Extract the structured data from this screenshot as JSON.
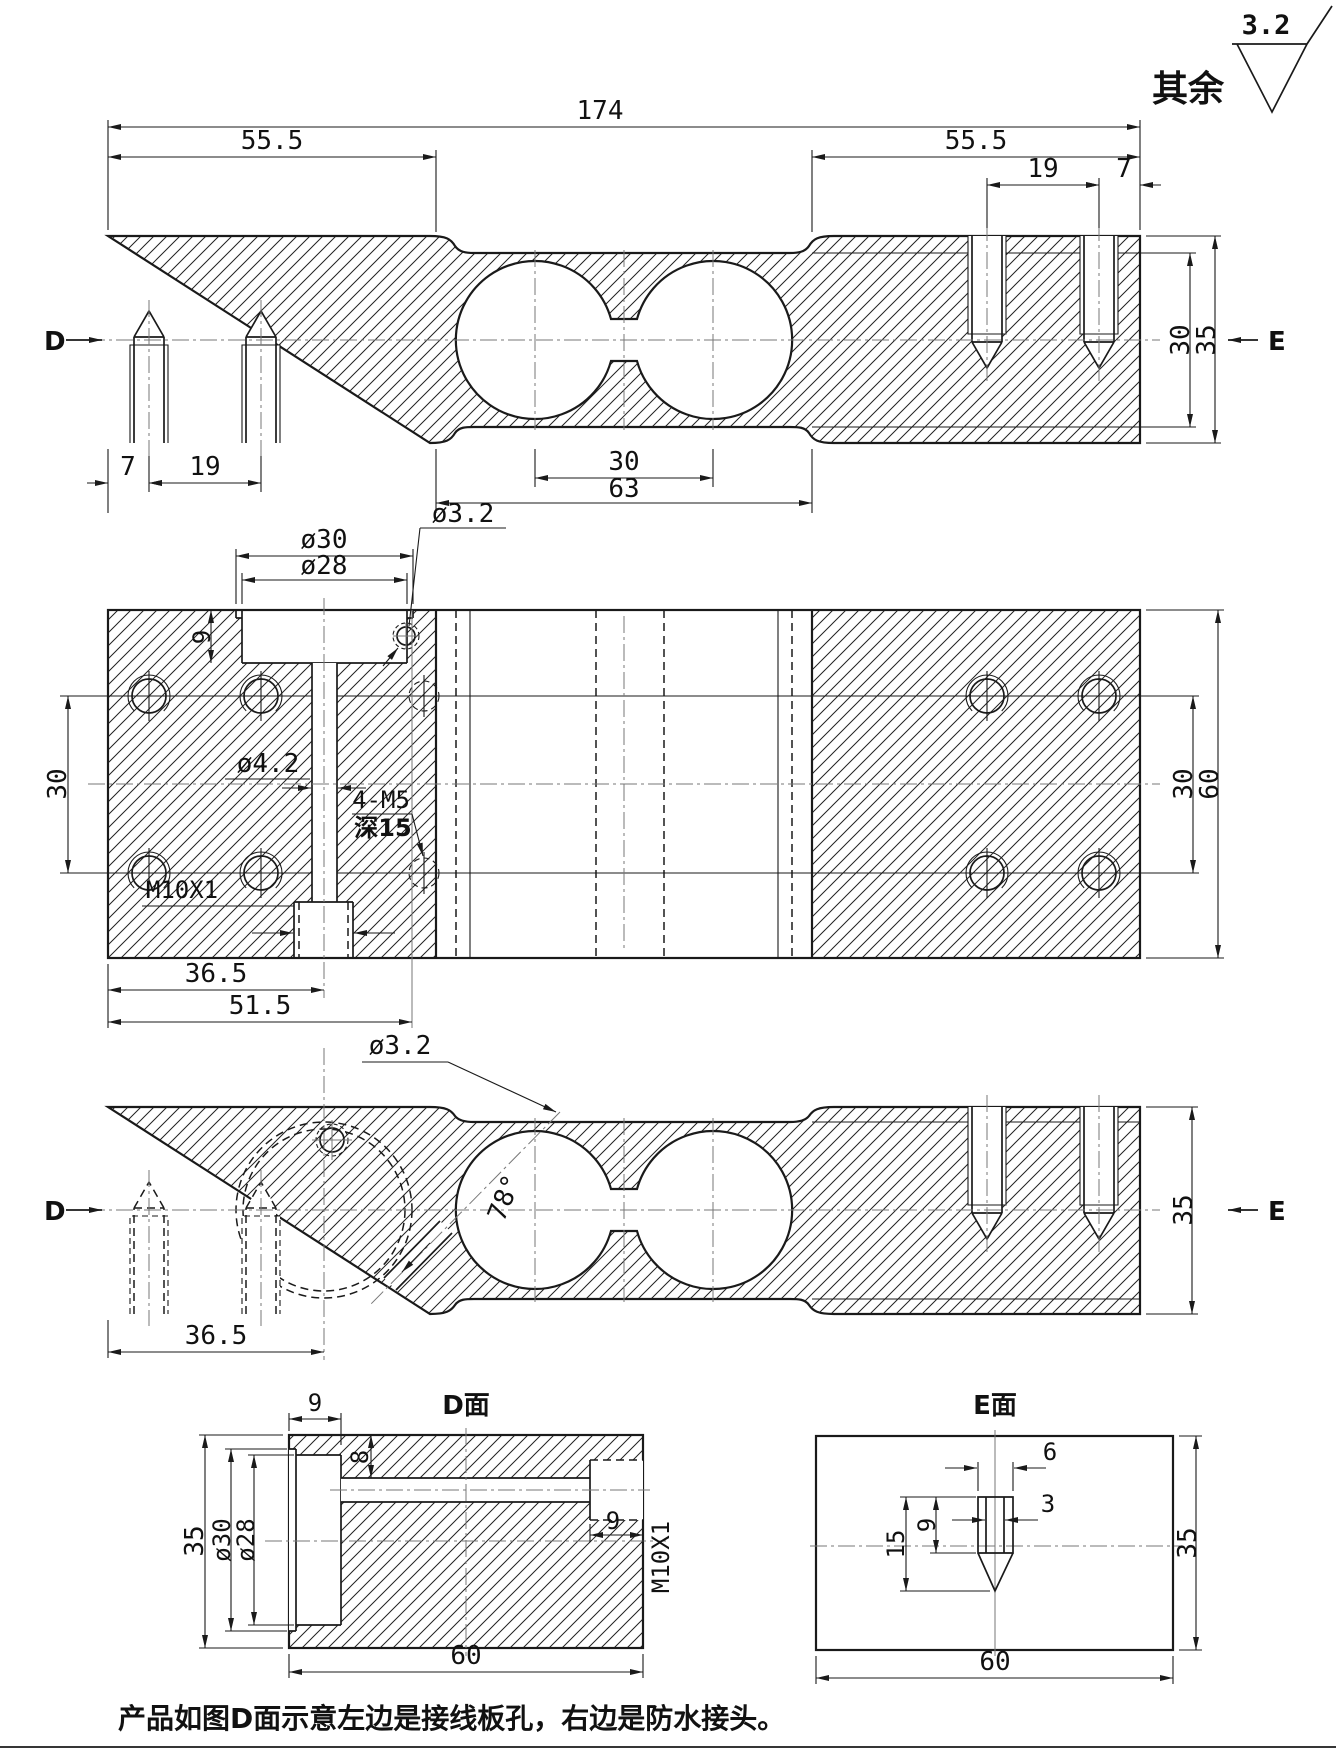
{
  "drawing": {
    "surface_finish": {
      "roughness": "3.2",
      "scope": "其余"
    },
    "note": "产品如图D面示意左边是接线板孔，右边是防水接头。",
    "labels": {
      "d": "D",
      "e": "E"
    },
    "view_top_section": {
      "dims": {
        "total_length": "174",
        "left_end": "55.5",
        "right_end": "55.5",
        "right_spacing": "19",
        "right_edge": "7",
        "left_edge": "7",
        "left_spacing": "19",
        "hole_centers": "30",
        "recess_width": "63",
        "inner_height": "30",
        "outer_height": "35"
      }
    },
    "view_plan": {
      "dims": {
        "boss_outer": "ø30",
        "boss_inner": "ø28",
        "cable_hole": "ø3.2",
        "boss_depth": "9",
        "left_rows": "30",
        "channel": "ø4.2",
        "thread_note": "4-M5",
        "depth_note": "深15",
        "gland_thread": "M10X1",
        "gland_offset": "36.5",
        "hole_offset": "51.5",
        "right_rows": "30",
        "width": "60"
      }
    },
    "view_lower_section": {
      "dims": {
        "cable_hole": "ø3.2",
        "angle": "78°",
        "gland_offset": "36.5",
        "height": "35"
      }
    },
    "view_d_face": {
      "title": "D面",
      "dims": {
        "boss_depth": "9",
        "channel_top": "8",
        "height": "35",
        "boss_outer": "ø30",
        "boss_inner": "ø28",
        "gland_depth": "9",
        "gland_thread": "M10X1",
        "width": "60"
      }
    },
    "view_e_face": {
      "title": "E面",
      "dims": {
        "hole_outer": "6",
        "hole_inner": "3",
        "hole_depth": "9",
        "total_depth": "15",
        "height": "35",
        "width": "60"
      }
    }
  }
}
